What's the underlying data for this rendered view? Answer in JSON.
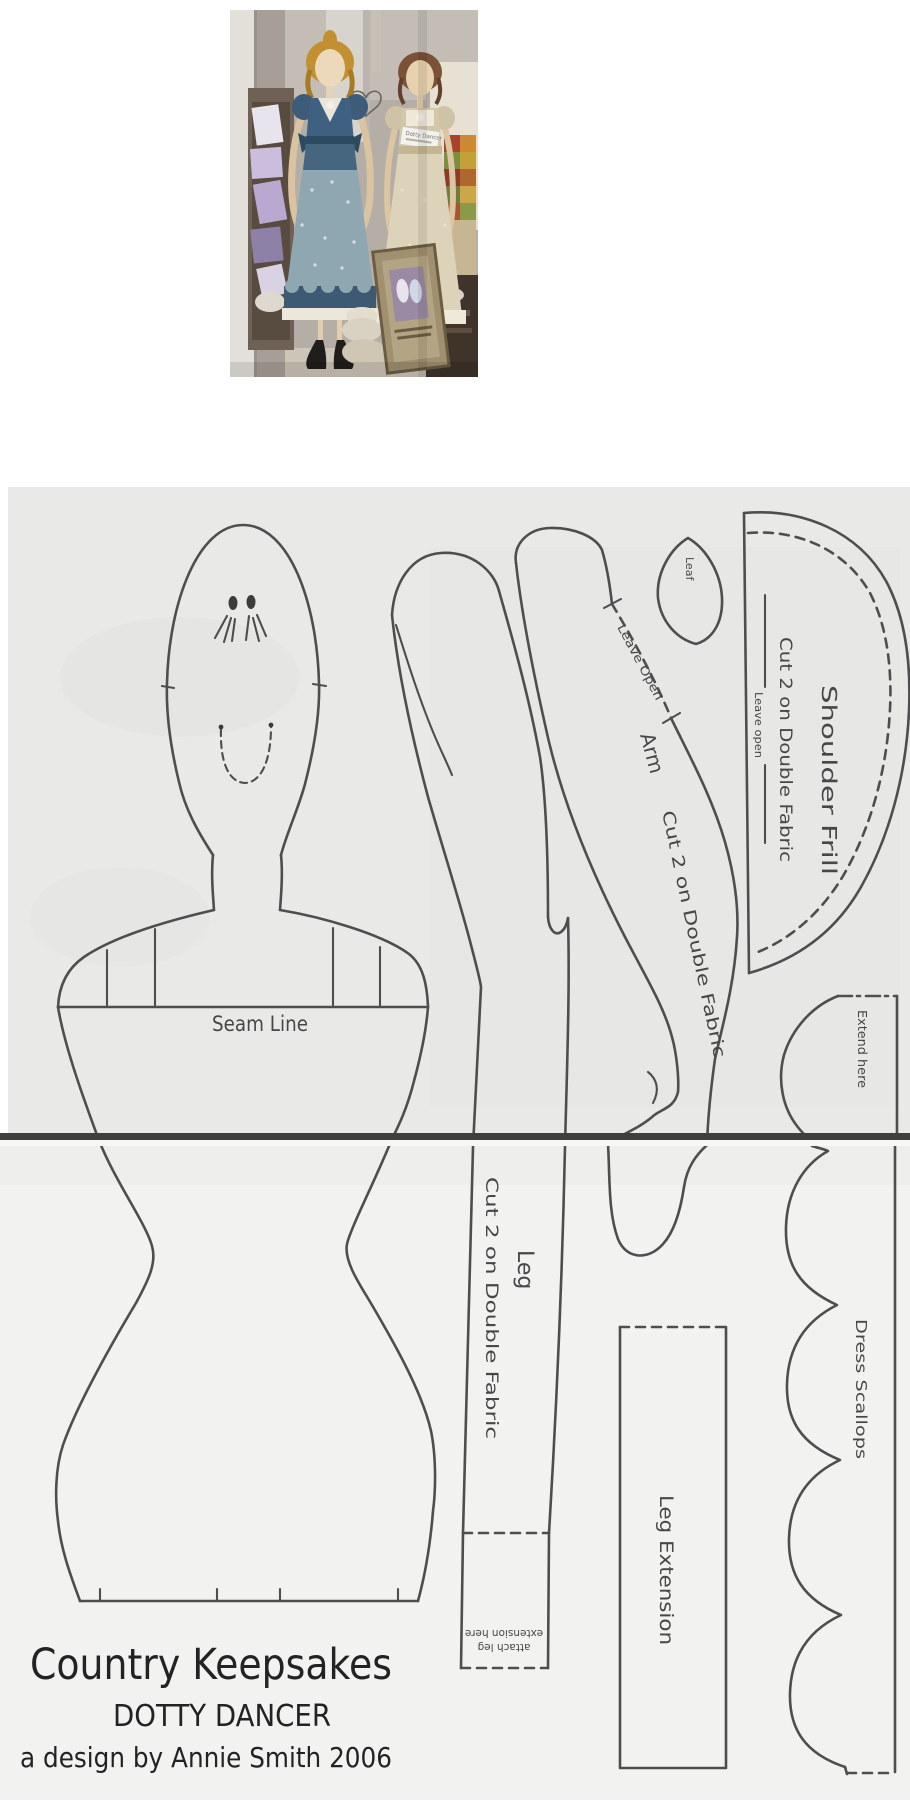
{
  "photo": {
    "doll_tag": "Dotty Dancer"
  },
  "pattern": {
    "body": {
      "seam_line": "Seam Line"
    },
    "arm": {
      "name": "Arm",
      "cut": "Cut 2  on Double Fabric",
      "leave_open": "Leave Open"
    },
    "leaf": {
      "name": "Leaf"
    },
    "shoulder_frill": {
      "name": "Shoulder Frill",
      "cut": "Cut 2 on Double Fabric",
      "leave_open": "Leave open"
    },
    "dress_scallops": {
      "name": "Dress Scallops",
      "extend": "Extend here"
    },
    "leg": {
      "name": "Leg",
      "cut": "Cut 2 on Double Fabric",
      "attach_line1": "attach leg",
      "attach_line2": "extension here"
    },
    "leg_extension": {
      "name": "Leg Extension"
    },
    "footer": {
      "brand": "Country Keepsakes",
      "title": "DOTTY DANCER",
      "credit": "a design by Annie Smith 2006"
    }
  },
  "colors": {
    "pattern_line": "#4e4e4e",
    "paper_upper": "#e9eae7",
    "paper_lower": "#f2f3f0",
    "page_break": "#3f3f3f",
    "doll1_dress": "#3f6080",
    "doll1_skirt": "#8fa7b0",
    "doll2_dress": "#d3c7a8",
    "ink": "#232323"
  }
}
